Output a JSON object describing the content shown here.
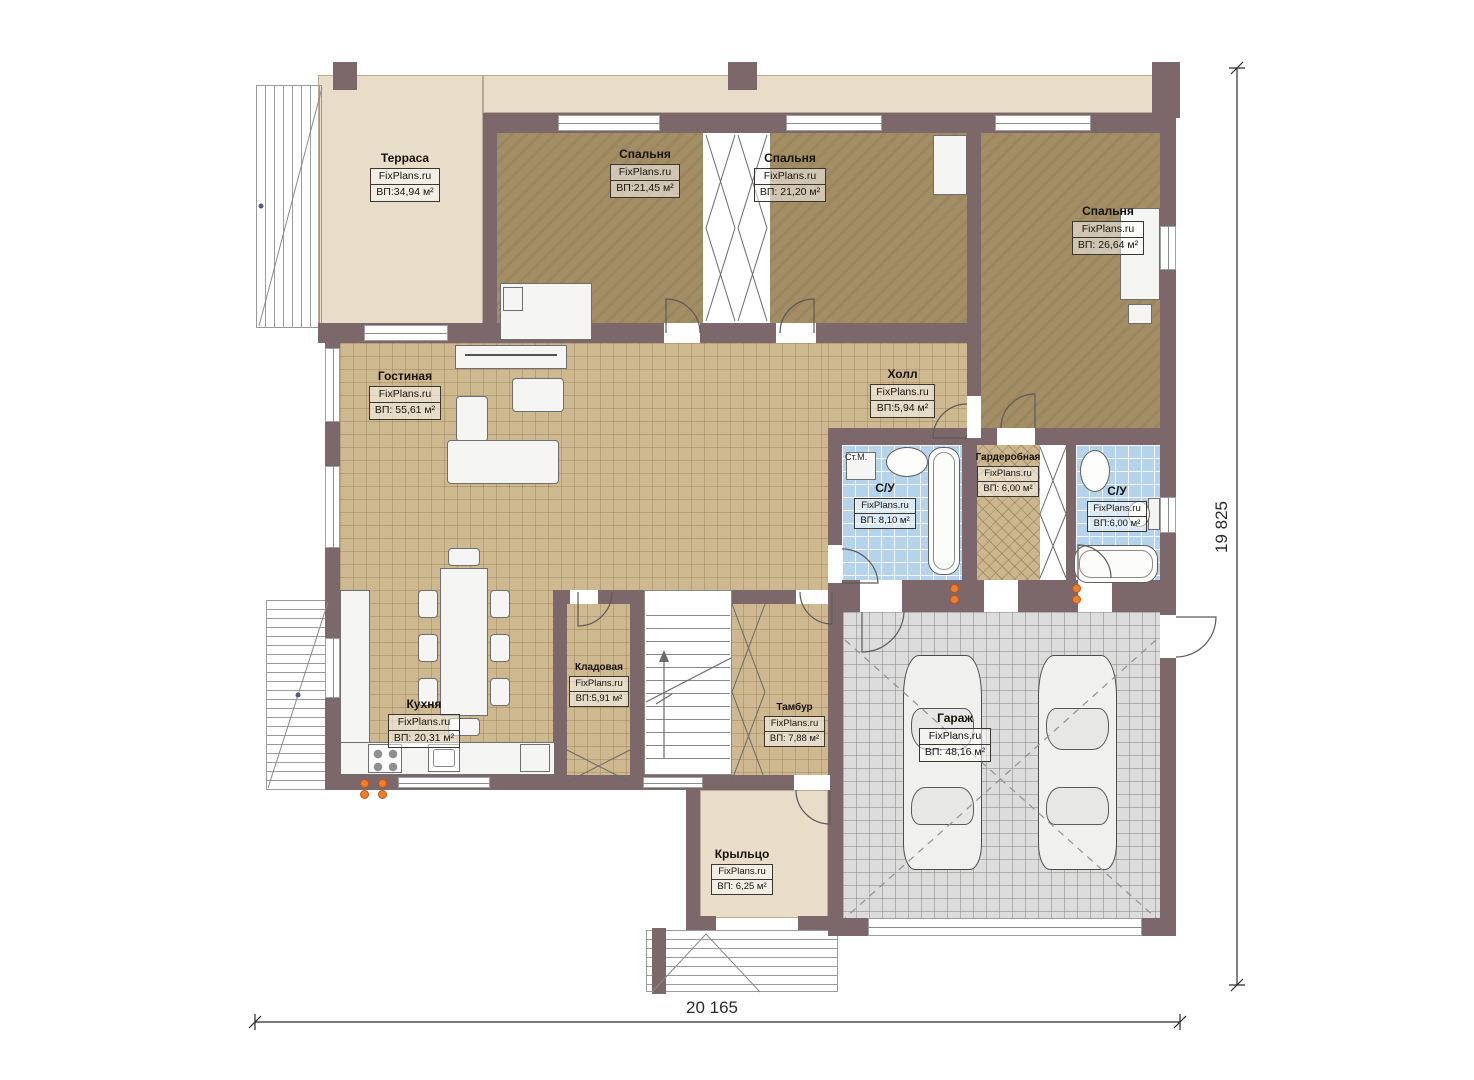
{
  "rooms": [
    {
      "name": "Терраса",
      "brand": "FixPlans.ru",
      "area": "ВП:34,94 м²"
    },
    {
      "name": "Спальня",
      "brand": "FixPlans.ru",
      "area": "ВП:21,45 м²"
    },
    {
      "name": "Спальня",
      "brand": "FixPlans.ru",
      "area": "ВП: 21,20 м²"
    },
    {
      "name": "Спальня",
      "brand": "FixPlans.ru",
      "area": "ВП: 26,64 м²"
    },
    {
      "name": "Гостиная",
      "brand": "FixPlans.ru",
      "area": "ВП: 55,61 м²"
    },
    {
      "name": "Холл",
      "brand": "FixPlans.ru",
      "area": "ВП:5,94 м²"
    },
    {
      "name": "С/У",
      "brand": "FixPlans.ru",
      "area": "ВП: 8,10 м²"
    },
    {
      "name": "Гардеробная",
      "brand": "FixPlans.ru",
      "area": "ВП: 6,00 м²"
    },
    {
      "name": "С/У",
      "brand": "FixPlans.ru",
      "area": "ВП:6,00 м²"
    },
    {
      "name": "Кухня",
      "brand": "FixPlans.ru",
      "area": "ВП: 20,31 м²"
    },
    {
      "name": "Кладовая",
      "brand": "FixPlans.ru",
      "area": "ВП:5,91 м²"
    },
    {
      "name": "Тамбур",
      "brand": "FixPlans.ru",
      "area": "ВП: 7,88 м²"
    },
    {
      "name": "Гараж",
      "brand": "FixPlans.ru",
      "area": "ВП: 48,16 м²"
    },
    {
      "name": "Крыльцо",
      "brand": "FixPlans.ru",
      "area": "ВП: 6,25 м²"
    }
  ],
  "annotations": {
    "washing_machine": "Ст.М."
  },
  "dimensions": {
    "width": "20 165",
    "height": "19 825"
  },
  "colors": {
    "wall": "#7c686a",
    "terrace": "#e7ddc9",
    "bedroom": "#a38d65",
    "tile": "#cdb88f",
    "bathroom": "#b5d3ea",
    "garage": "#dcdcdc",
    "radiator": "#ef7f2e",
    "background": "#ffffff"
  }
}
